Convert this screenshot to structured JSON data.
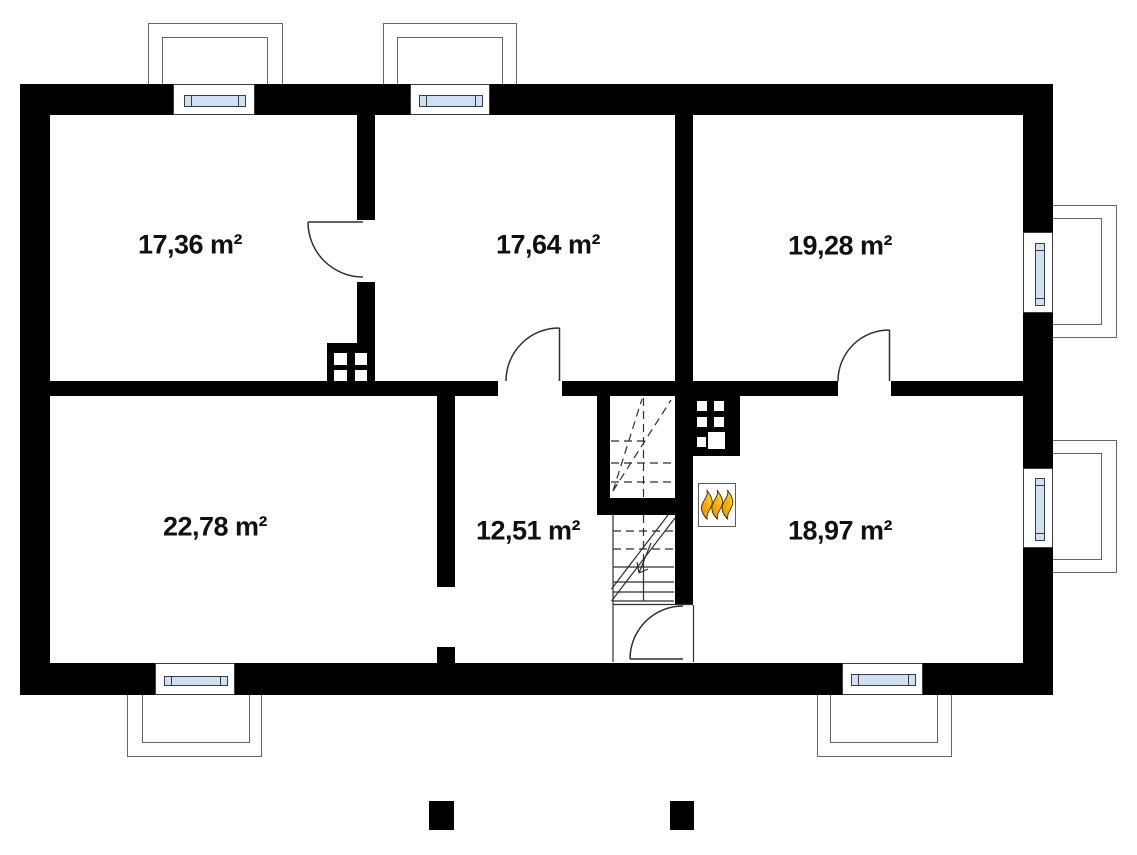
{
  "plan": {
    "type": "floor-plan",
    "rooms": [
      {
        "id": "top-left",
        "area_label": "17,36 m²"
      },
      {
        "id": "top-middle",
        "area_label": "17,64 m²"
      },
      {
        "id": "top-right",
        "area_label": "19,28 m²"
      },
      {
        "id": "bottom-left",
        "area_label": "22,78 m²"
      },
      {
        "id": "bottom-middle",
        "area_label": "12,51 m²"
      },
      {
        "id": "bottom-right",
        "area_label": "18,97 m²"
      }
    ],
    "icons": [
      {
        "name": "fireplace-flames-icon",
        "flame_count": 3
      }
    ]
  },
  "colors": {
    "wall": "#000000",
    "window_glass": "#cfe0f2",
    "bay_outline": "#666666",
    "plan_line": "#2f2f2f",
    "flame_orange": "#ef8800",
    "flame_yellow": "#ffe45e"
  }
}
